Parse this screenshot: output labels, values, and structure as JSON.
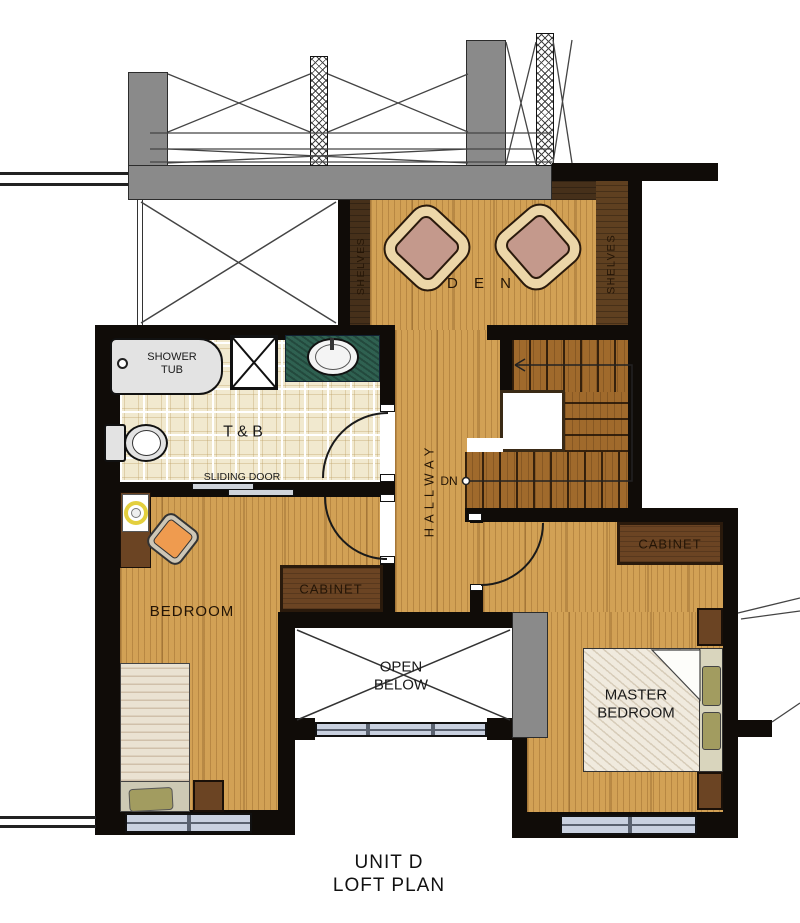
{
  "plan": {
    "title_line1": "UNIT D",
    "title_line2": "LOFT PLAN"
  },
  "labels": {
    "den": "D E N",
    "shelves": "SHELVES",
    "shower_tub": "SHOWER TUB",
    "toilet_bath": "T & B",
    "sliding_door": "SLIDING DOOR",
    "hallway": "HALLWAY",
    "down": "DN",
    "bedroom": "BEDROOM",
    "cabinet": "CABINET",
    "open_below": "OPEN BELOW",
    "master_bedroom": "MASTER BEDROOM"
  },
  "colors": {
    "wall": "#100c08",
    "wood": "#d2a155",
    "stair_wood": "#a06a2c",
    "shelf_dark": "#46301a",
    "shelf_mid": "#5f4020",
    "cabinet": "#6b4423",
    "gray_concrete": "#8a8a8a",
    "tile": "#f1e9cf",
    "counter_green": "#2f6151",
    "window_glass": "#c9d1e0",
    "blanket": "#eae2d2",
    "master_blanket": "#f0eade",
    "bed_base": "#cdc9b4",
    "pillow_olive": "#a29c60",
    "chair_orange": "#ef9b4f",
    "chair_frame": "#cdc6b6",
    "den_chair_seat": "#c4998c",
    "den_chair_frame": "#ecd6a8",
    "fixture_gray": "#e3e3e3",
    "ink": "#241506"
  }
}
